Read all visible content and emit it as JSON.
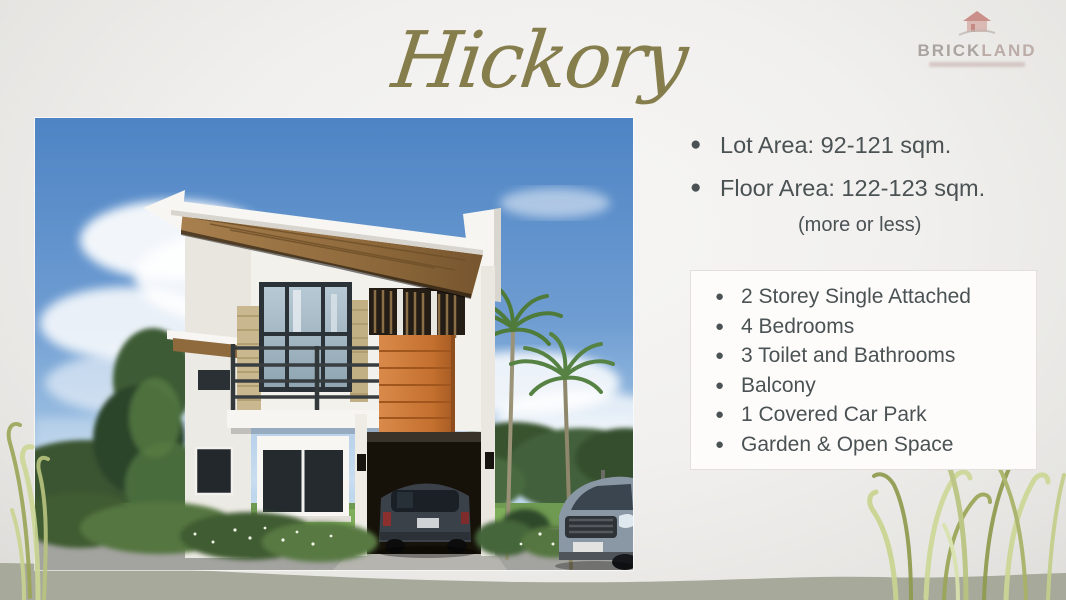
{
  "slide_title": "Hickory",
  "logo": {
    "brand_primary": "BRICK",
    "brand_secondary": "LAND"
  },
  "specs": {
    "items": [
      "Lot Area: 92-121 sqm.",
      "Floor Area: 122-123 sqm."
    ],
    "note": "(more or less)"
  },
  "features": {
    "items": [
      "2 Storey Single Attached",
      "4 Bedrooms",
      "3 Toilet and Bathrooms",
      "Balcony",
      "1 Covered Car Park",
      "Garden & Open Space"
    ]
  },
  "palette": {
    "title_olive": "#857d4c",
    "body_text_gray": "#4b5254",
    "logo_red": "#b4524a",
    "bottom_band_gray": "#a7a99b",
    "house_accent_orange": "#c4702f",
    "features_box_border": "#e3dfdc"
  }
}
